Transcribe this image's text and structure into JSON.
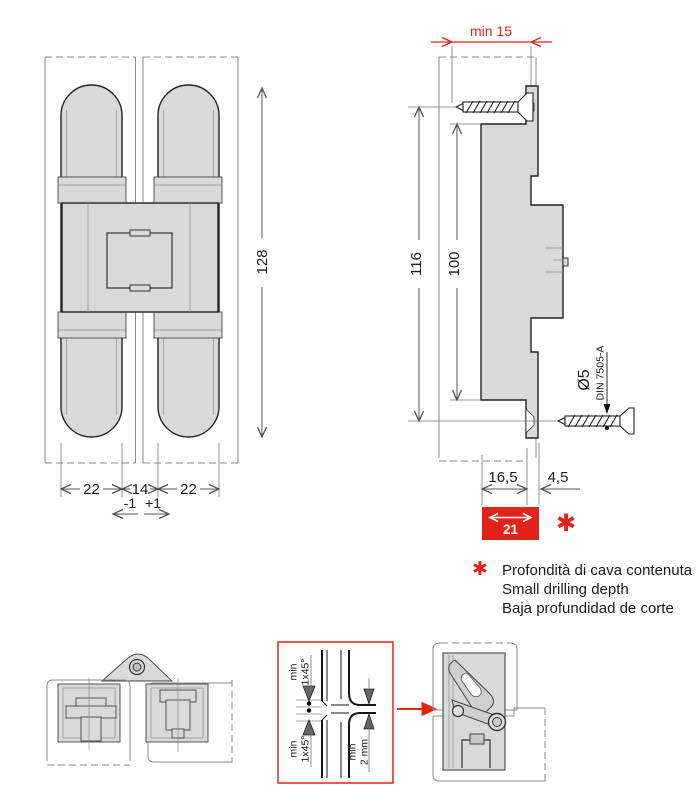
{
  "colors": {
    "accent_red": "#e2231a",
    "part_fill": "#d9d9d9",
    "drawing_line": "#222222",
    "dimension_line": "#555555"
  },
  "front_view": {
    "dims": {
      "height": "128",
      "left": "22",
      "center": "14",
      "right": "22",
      "tol_minus": "-1",
      "tol_plus": "+1"
    }
  },
  "side_view": {
    "dims": {
      "min_edge": "min 15",
      "outer": "116",
      "inner": "100",
      "groove": "16,5",
      "offset": "4,5",
      "total": "21"
    },
    "screw": {
      "diameter": "Ø5",
      "standard": "DIN 7505-A"
    },
    "note_marker": "✱"
  },
  "footnote": {
    "marker": "✱",
    "lines": [
      "Profondità di cava contenuta",
      "Small drilling depth",
      "Baja profundidad de corte"
    ]
  },
  "detail": {
    "chamfer_min": "min",
    "chamfer_val": "1x45°",
    "gap_min": "min",
    "gap_val": "2 mm"
  }
}
